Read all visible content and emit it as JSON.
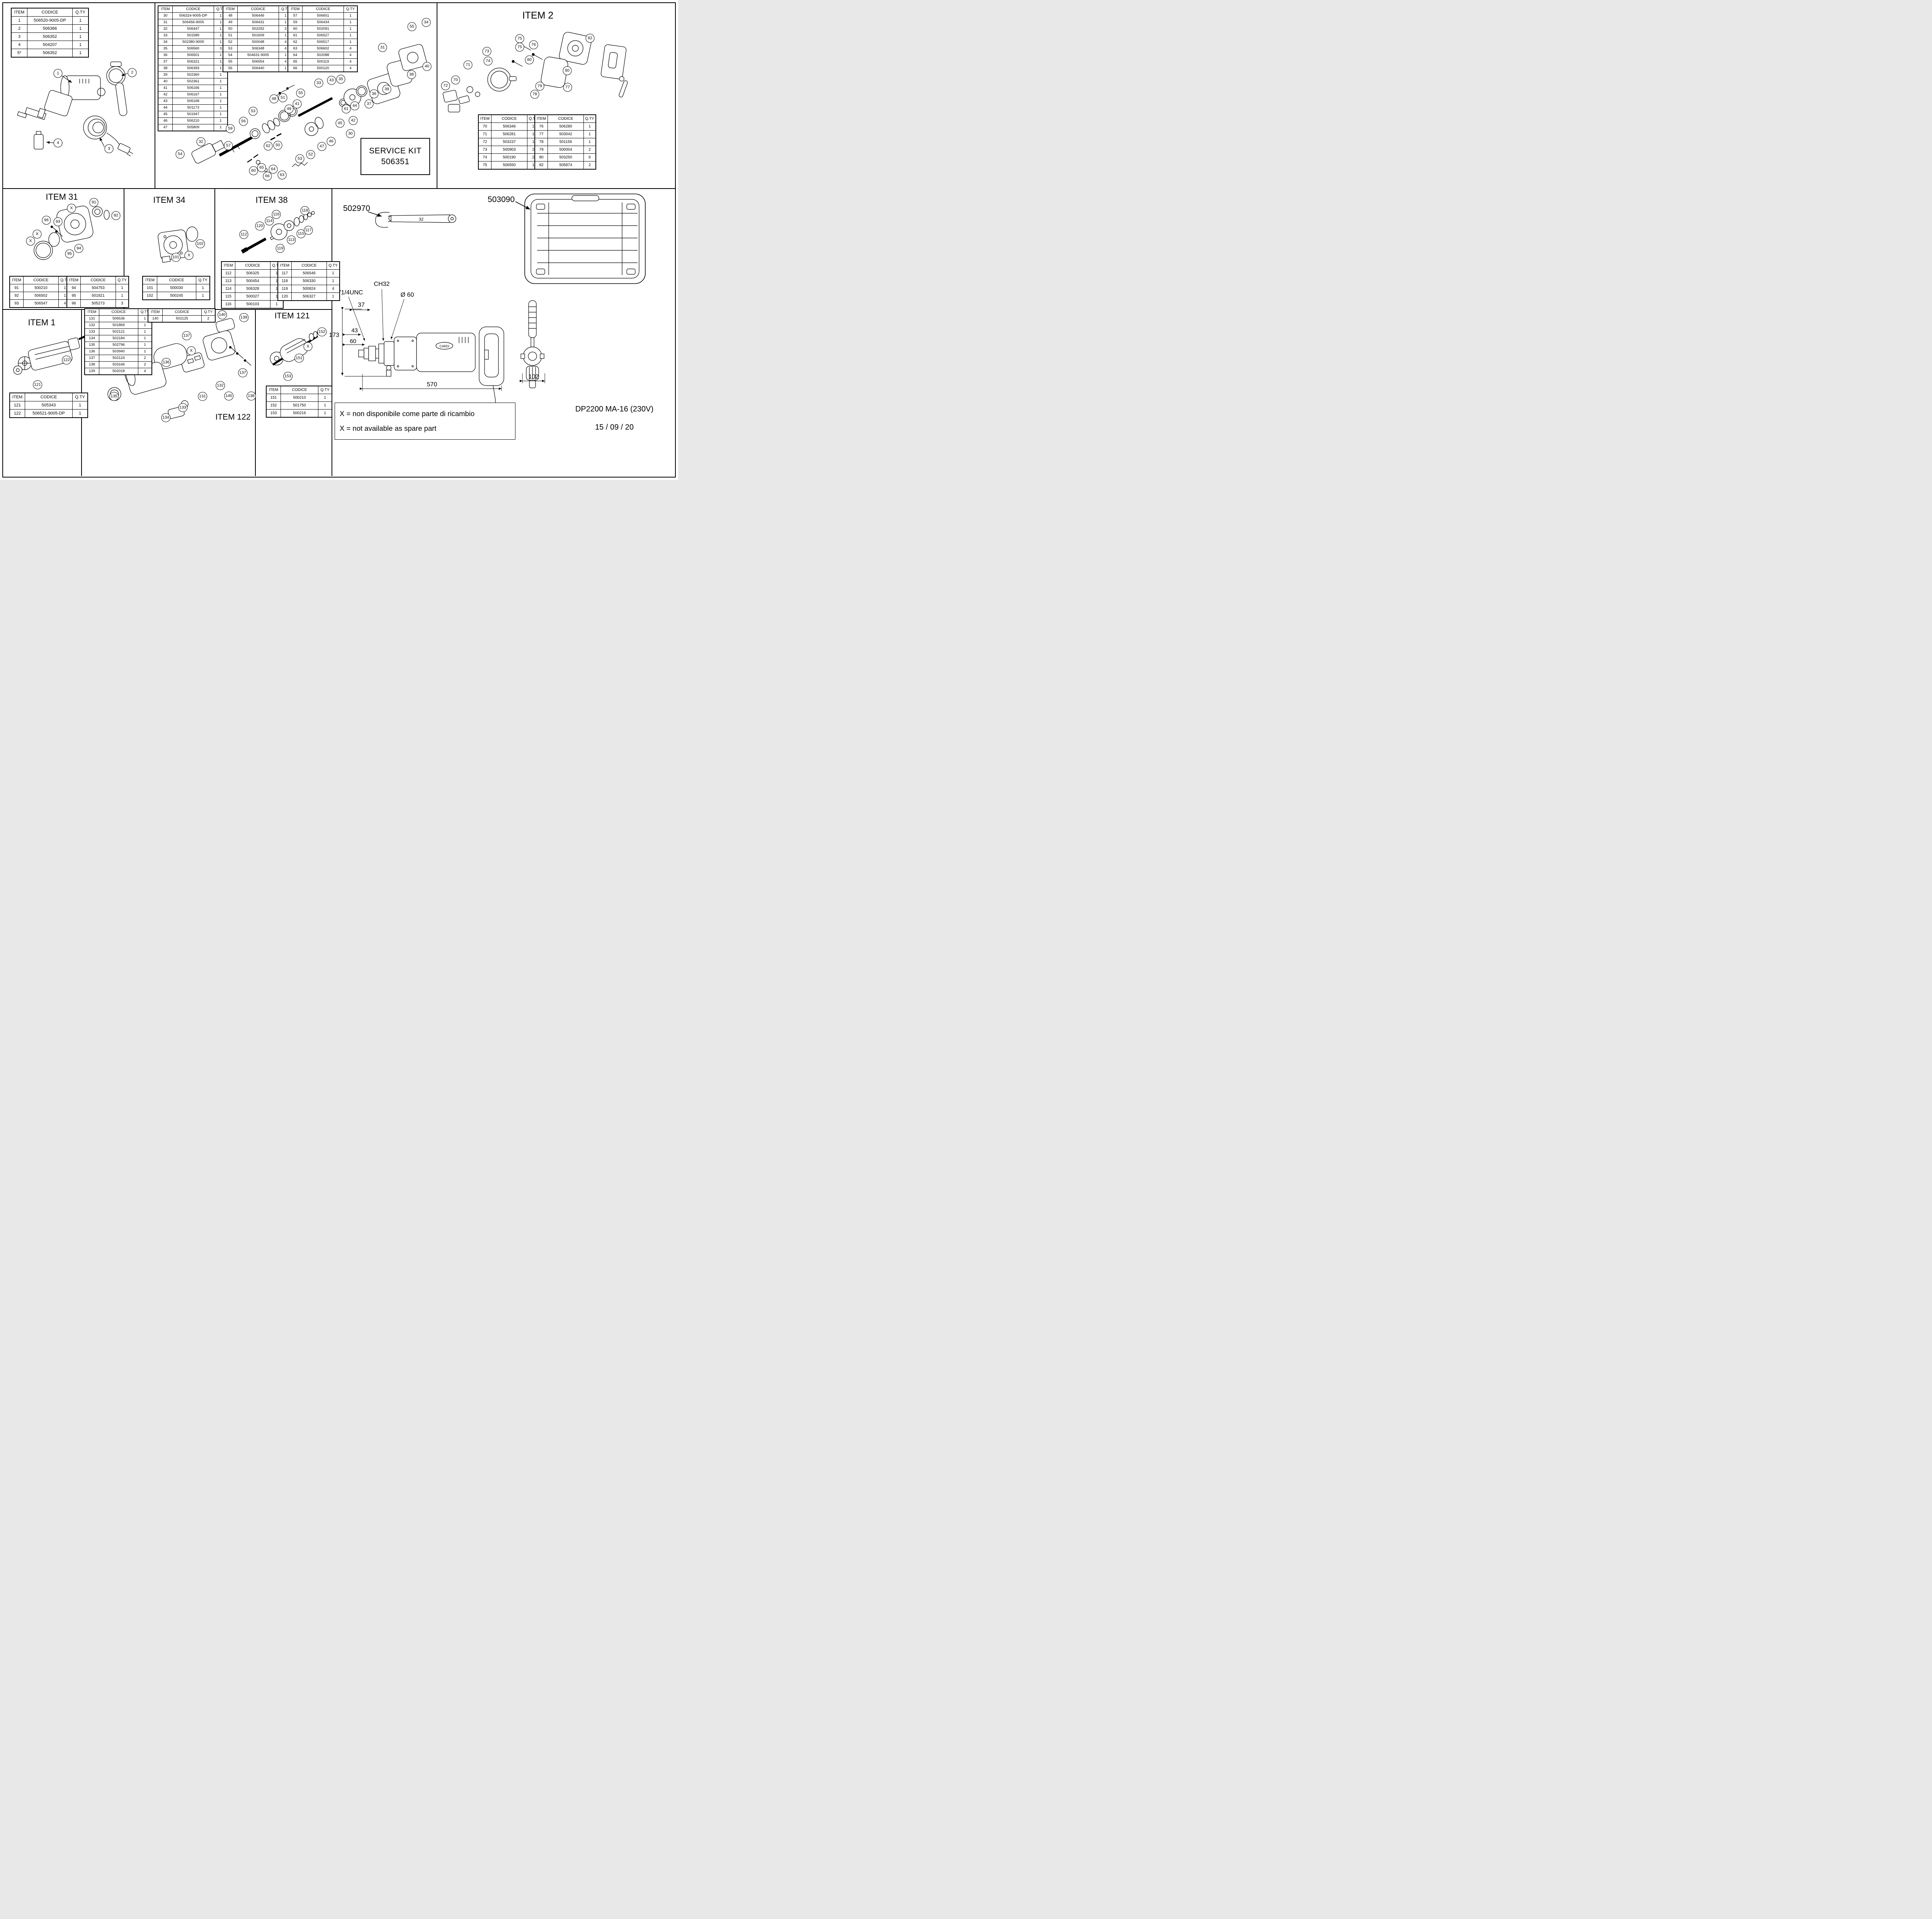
{
  "page": {
    "model": "DP2200 MA-16 (230V)",
    "date": "15 / 09 / 20",
    "brand": "CARDI"
  },
  "notes": {
    "it": "X = non disponibile come parte di ricambio",
    "en": "X = not available as spare part"
  },
  "service_kit": {
    "line1": "SERVICE KIT",
    "line2": "506351"
  },
  "labels": {
    "item2": "ITEM 2",
    "item31": "ITEM 31",
    "item34": "ITEM 34",
    "item38": "ITEM 38",
    "item1": "ITEM 1",
    "item121": "ITEM 121",
    "item122": "ITEM 122",
    "wrench_code": "502970",
    "wrench_size": "32",
    "case_code": "503090"
  },
  "dims": {
    "thread": "1\"1/4UNC",
    "ch": "CH32",
    "dia": "Ø 60",
    "d37": "37",
    "d43": "43",
    "d60": "60",
    "d173": "173",
    "d570": "570",
    "d102": "102"
  },
  "tables": {
    "headers": [
      "ITEM",
      "CODICE",
      "Q.TY"
    ],
    "main_left": {
      "rows": [
        [
          "1",
          "506520-9005-DP",
          "1"
        ],
        [
          "2",
          "506366",
          "1"
        ],
        [
          "3",
          "506352",
          "1"
        ],
        [
          "4",
          "504207",
          "1"
        ],
        [
          "5*",
          "506352",
          "1"
        ]
      ]
    },
    "exploded_a": {
      "rows": [
        [
          "30",
          "506324-9005-DP",
          "1"
        ],
        [
          "31",
          "506456-9005",
          "1"
        ],
        [
          "32",
          "506447",
          "1"
        ],
        [
          "33",
          "501589",
          "1"
        ],
        [
          "34",
          "502380-9005",
          "1"
        ],
        [
          "35",
          "506560",
          "3"
        ],
        [
          "36",
          "506501",
          "1"
        ],
        [
          "37",
          "506321",
          "1"
        ],
        [
          "38",
          "506393",
          "1"
        ],
        [
          "39",
          "502360",
          "1"
        ],
        [
          "40",
          "502361",
          "1"
        ],
        [
          "41",
          "506166",
          "1"
        ],
        [
          "42",
          "506167",
          "1"
        ],
        [
          "43",
          "506168",
          "1"
        ],
        [
          "44",
          "501173",
          "1"
        ],
        [
          "45",
          "501947",
          "1"
        ],
        [
          "46",
          "506210",
          "1"
        ],
        [
          "47",
          "505809",
          "1"
        ]
      ]
    },
    "exploded_b": {
      "rows": [
        [
          "48",
          "506446",
          "1"
        ],
        [
          "49",
          "506431",
          "1"
        ],
        [
          "50",
          "502292",
          "3"
        ],
        [
          "51",
          "501609",
          "1"
        ],
        [
          "52",
          "500048",
          "4"
        ],
        [
          "53",
          "506348",
          "4"
        ],
        [
          "54",
          "504631-9005",
          "1"
        ],
        [
          "55",
          "506554",
          "4"
        ],
        [
          "56",
          "506440",
          "1"
        ]
      ]
    },
    "exploded_c": {
      "rows": [
        [
          "57",
          "506601",
          "1"
        ],
        [
          "59",
          "506434",
          "1"
        ],
        [
          "60",
          "502091",
          "1"
        ],
        [
          "61",
          "506527",
          "1"
        ],
        [
          "62",
          "506517",
          "1"
        ],
        [
          "63",
          "506602",
          "4"
        ],
        [
          "64",
          "502088",
          "4"
        ],
        [
          "65",
          "500119",
          "4"
        ],
        [
          "66",
          "500120",
          "4"
        ]
      ]
    },
    "item2_a": {
      "rows": [
        [
          "70",
          "506346",
          "1"
        ],
        [
          "71",
          "506281",
          "1"
        ],
        [
          "72",
          "503237",
          "1"
        ],
        [
          "73",
          "500903",
          "2"
        ],
        [
          "74",
          "500190",
          "2"
        ],
        [
          "75",
          "506550",
          "1"
        ]
      ]
    },
    "item2_b": {
      "rows": [
        [
          "76",
          "506280",
          "1"
        ],
        [
          "77",
          "503042",
          "1"
        ],
        [
          "78",
          "501156",
          "1"
        ],
        [
          "79",
          "500004",
          "2"
        ],
        [
          "80",
          "503250",
          "6"
        ],
        [
          "82",
          "505874",
          "2"
        ]
      ]
    },
    "item31_a": {
      "rows": [
        [
          "91",
          "500210",
          "1"
        ],
        [
          "92",
          "506502",
          "1"
        ],
        [
          "93",
          "506547",
          "4"
        ]
      ]
    },
    "item31_b": {
      "rows": [
        [
          "94",
          "504753",
          "1"
        ],
        [
          "95",
          "501821",
          "1"
        ],
        [
          "96",
          "505273",
          "3"
        ]
      ]
    },
    "item34": {
      "rows": [
        [
          "101",
          "500030",
          "1"
        ],
        [
          "102",
          "500245",
          "1"
        ]
      ]
    },
    "item38_a": {
      "rows": [
        [
          "112",
          "506325",
          "1"
        ],
        [
          "113",
          "500454",
          "1"
        ],
        [
          "114",
          "506328",
          "1"
        ],
        [
          "115",
          "500027",
          "1"
        ],
        [
          "116",
          "500103",
          "1"
        ]
      ]
    },
    "item38_b": {
      "rows": [
        [
          "117",
          "506546",
          "1"
        ],
        [
          "118",
          "506330",
          "1"
        ],
        [
          "119",
          "500824",
          "4"
        ],
        [
          "120",
          "506327",
          "1"
        ]
      ]
    },
    "item1": {
      "rows": [
        [
          "121",
          "505343",
          "1"
        ],
        [
          "122",
          "506521-9005-DP",
          "1"
        ]
      ]
    },
    "item122_a": {
      "rows": [
        [
          "131",
          "506536",
          "1"
        ],
        [
          "132",
          "501869",
          "1"
        ],
        [
          "133",
          "502121",
          "1"
        ],
        [
          "134",
          "502184",
          "1"
        ],
        [
          "135",
          "502796",
          "1"
        ],
        [
          "136",
          "503940",
          "1"
        ],
        [
          "137",
          "502124",
          "2"
        ],
        [
          "138",
          "503166",
          "2"
        ],
        [
          "139",
          "502018",
          "4"
        ]
      ]
    },
    "item122_b": {
      "rows": [
        [
          "140",
          "502125",
          "2"
        ]
      ]
    },
    "item121": {
      "rows": [
        [
          "151",
          "500210",
          "1"
        ],
        [
          "152",
          "501750",
          "1"
        ],
        [
          "153",
          "500216",
          "1"
        ]
      ]
    }
  },
  "callouts": {
    "top_left": [
      [
        "1",
        150,
        190
      ],
      [
        "2",
        342,
        188
      ],
      [
        "3",
        282,
        385
      ],
      [
        "4",
        150,
        370
      ]
    ],
    "center": [
      [
        "48",
        709,
        256
      ],
      [
        "51",
        732,
        253
      ],
      [
        "49",
        748,
        282
      ],
      [
        "41",
        769,
        269
      ],
      [
        "55",
        778,
        241
      ],
      [
        "33",
        825,
        215
      ],
      [
        "43",
        858,
        208
      ],
      [
        "35",
        882,
        205
      ],
      [
        "31",
        990,
        123
      ],
      [
        "55",
        1066,
        69
      ],
      [
        "34",
        1103,
        58
      ],
      [
        "40",
        1105,
        172
      ],
      [
        "38",
        1065,
        193
      ],
      [
        "36",
        968,
        243
      ],
      [
        "39",
        1001,
        231
      ],
      [
        "37",
        955,
        269
      ],
      [
        "61",
        896,
        282
      ],
      [
        "44",
        918,
        274
      ],
      [
        "42",
        914,
        312
      ],
      [
        "45",
        880,
        319
      ],
      [
        "30",
        907,
        346
      ],
      [
        "46",
        857,
        366
      ],
      [
        "47",
        833,
        379
      ],
      [
        "52",
        804,
        400
      ],
      [
        "53",
        776,
        411
      ],
      [
        "50",
        719,
        376
      ],
      [
        "62",
        694,
        378
      ],
      [
        "63",
        730,
        453
      ],
      [
        "64",
        707,
        438
      ],
      [
        "65",
        677,
        434
      ],
      [
        "66",
        692,
        456
      ],
      [
        "60",
        656,
        442
      ],
      [
        "59",
        596,
        333
      ],
      [
        "57",
        591,
        377
      ],
      [
        "32",
        520,
        367
      ],
      [
        "56",
        630,
        314
      ],
      [
        "54",
        466,
        399
      ],
      [
        "53",
        655,
        288
      ]
    ],
    "item2": [
      [
        "75",
        1345,
        100
      ],
      [
        "75",
        1345,
        122
      ],
      [
        "76",
        1381,
        116
      ],
      [
        "82",
        1527,
        99
      ],
      [
        "80",
        1370,
        155
      ],
      [
        "80",
        1468,
        183
      ],
      [
        "73",
        1260,
        133
      ],
      [
        "74",
        1263,
        158
      ],
      [
        "71",
        1211,
        168
      ],
      [
        "70",
        1179,
        207
      ],
      [
        "72",
        1153,
        222
      ],
      [
        "79",
        1397,
        223
      ],
      [
        "78",
        1384,
        244
      ],
      [
        "77",
        1469,
        226
      ]
    ],
    "item31": [
      [
        "X",
        185,
        539
      ],
      [
        "91",
        243,
        524
      ],
      [
        "92",
        300,
        558
      ],
      [
        "96",
        120,
        570
      ],
      [
        "93",
        150,
        574
      ],
      [
        "X",
        96,
        606
      ],
      [
        "X",
        79,
        624
      ],
      [
        "94",
        204,
        643
      ],
      [
        "95",
        180,
        657
      ]
    ],
    "item34": [
      [
        "102",
        518,
        631
      ],
      [
        "X",
        489,
        661
      ],
      [
        "101",
        455,
        666
      ]
    ],
    "item38": [
      [
        "118",
        789,
        545
      ],
      [
        "116",
        715,
        555
      ],
      [
        "114",
        697,
        572
      ],
      [
        "120",
        672,
        585
      ],
      [
        "112",
        631,
        607
      ],
      [
        "115",
        779,
        605
      ],
      [
        "117",
        798,
        596
      ],
      [
        "113",
        754,
        621
      ],
      [
        "119",
        725,
        643
      ]
    ],
    "item1": [
      [
        "122",
        172,
        932
      ],
      [
        "121",
        97,
        996
      ]
    ],
    "item122": [
      [
        "140",
        575,
        815
      ],
      [
        "139",
        631,
        822
      ],
      [
        "137",
        483,
        869
      ],
      [
        "X",
        495,
        908
      ],
      [
        "136",
        430,
        938
      ],
      [
        "137",
        628,
        965
      ],
      [
        "132",
        570,
        998
      ],
      [
        "131",
        524,
        1026
      ],
      [
        "140",
        592,
        1025
      ],
      [
        "138",
        650,
        1025
      ],
      [
        "135",
        295,
        1026
      ],
      [
        "133",
        473,
        1055
      ],
      [
        "134",
        429,
        1081
      ]
    ],
    "item121": [
      [
        "152",
        833,
        859
      ],
      [
        "X",
        797,
        897
      ],
      [
        "151",
        774,
        927
      ],
      [
        "153",
        745,
        974
      ]
    ]
  }
}
